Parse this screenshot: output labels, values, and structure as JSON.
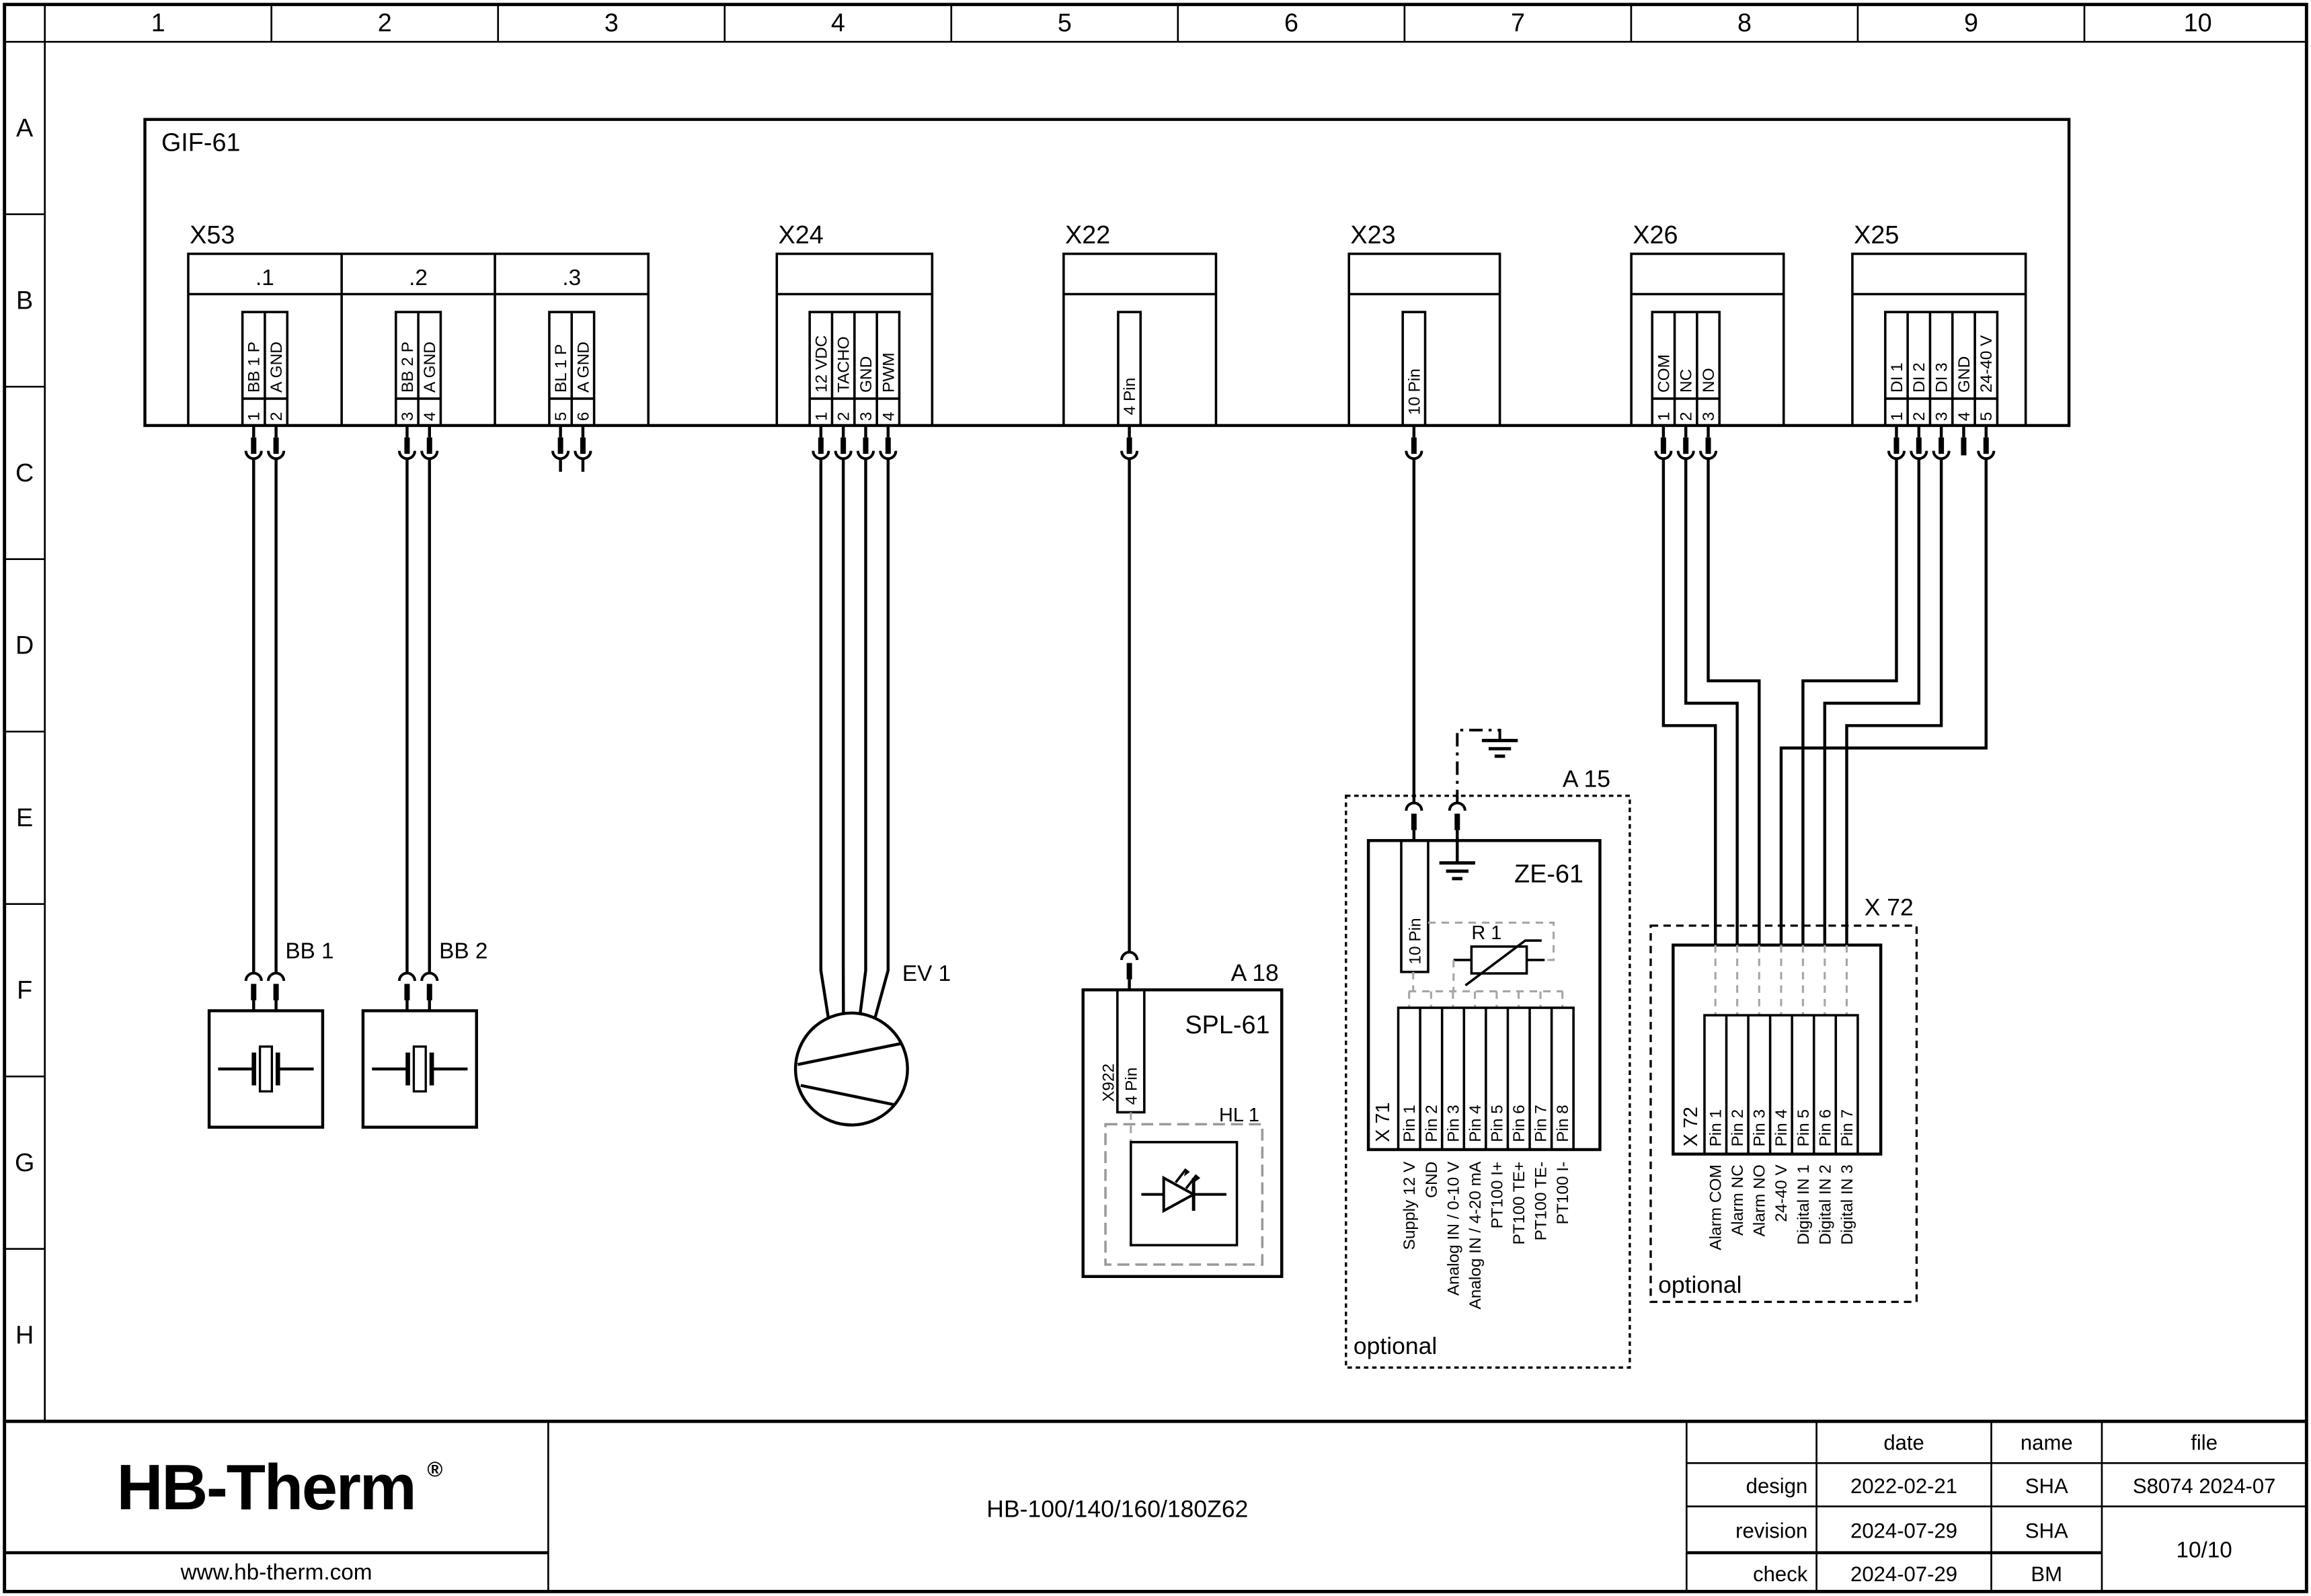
{
  "grid": {
    "cols": [
      "1",
      "2",
      "3",
      "4",
      "5",
      "6",
      "7",
      "8",
      "9",
      "10"
    ],
    "rows": [
      "A",
      "B",
      "C",
      "D",
      "E",
      "F",
      "G",
      "H"
    ]
  },
  "module": {
    "name": "GIF-61"
  },
  "x53": {
    "name": "X53",
    "sections": [
      {
        "id": ".1",
        "pins": [
          {
            "no": "1",
            "label": "BB 1 P"
          },
          {
            "no": "2",
            "label": "A GND"
          }
        ]
      },
      {
        "id": ".2",
        "pins": [
          {
            "no": "3",
            "label": "BB 2 P"
          },
          {
            "no": "4",
            "label": "A GND"
          }
        ]
      },
      {
        "id": ".3",
        "pins": [
          {
            "no": "5",
            "label": "BL 1 P"
          },
          {
            "no": "6",
            "label": "A GND"
          }
        ]
      }
    ]
  },
  "x24": {
    "name": "X24",
    "pins": [
      {
        "no": "1",
        "label": "12 VDC"
      },
      {
        "no": "2",
        "label": "TACHO"
      },
      {
        "no": "3",
        "label": "GND"
      },
      {
        "no": "4",
        "label": "PWM"
      }
    ]
  },
  "x22": {
    "name": "X22",
    "pin": "4 Pin"
  },
  "x23": {
    "name": "X23",
    "pin": "10 Pin"
  },
  "x26": {
    "name": "X26",
    "pins": [
      {
        "no": "1",
        "label": "COM"
      },
      {
        "no": "2",
        "label": "NC"
      },
      {
        "no": "3",
        "label": "NO"
      }
    ]
  },
  "x25": {
    "name": "X25",
    "pins": [
      {
        "no": "1",
        "label": "DI 1"
      },
      {
        "no": "2",
        "label": "DI 2"
      },
      {
        "no": "3",
        "label": "DI 3"
      },
      {
        "no": "4",
        "label": "GND"
      },
      {
        "no": "5",
        "label": "24-40 V"
      }
    ]
  },
  "bb1": {
    "name": "BB 1"
  },
  "bb2": {
    "name": "BB 2"
  },
  "ev1": {
    "name": "EV 1"
  },
  "a18": {
    "ref": "A 18",
    "name": "SPL-61",
    "connector": "X922",
    "pin": "4 Pin",
    "lamp": "HL 1"
  },
  "a15": {
    "ref": "A 15",
    "name": "ZE-61",
    "pin": "10 Pin",
    "resistor": "R 1",
    "terminal": "X 71",
    "pins": [
      "Pin 1",
      "Pin 2",
      "Pin 3",
      "Pin 4",
      "Pin 5",
      "Pin 6",
      "Pin 7",
      "Pin 8"
    ],
    "functions": [
      "Supply 12 V",
      "GND",
      "Analog IN / 0-10 V",
      "Analog IN / 4-20 mA",
      "PT100 I+",
      "PT100 TE+",
      "PT100 TE-",
      "PT100 I-"
    ],
    "note": "optional"
  },
  "x72": {
    "ref": "X 72",
    "terminal": "X 72",
    "pins": [
      "Pin 1",
      "Pin 2",
      "Pin 3",
      "Pin 4",
      "Pin 5",
      "Pin 6",
      "Pin 7"
    ],
    "functions": [
      "Alarm COM",
      "Alarm NC",
      "Alarm NO",
      "24-40 V",
      "Digital IN 1",
      "Digital IN 2",
      "Digital IN 3"
    ],
    "note": "optional"
  },
  "titleblock": {
    "logo": "HB-Therm",
    "registered": "®",
    "website": "www.hb-therm.com",
    "doc_title": "HB-100/140/160/180Z62",
    "headers": {
      "date": "date",
      "name": "name",
      "file": "file"
    },
    "entries": [
      {
        "label": "design",
        "date": "2022-02-21",
        "name": "SHA"
      },
      {
        "label": "revision",
        "date": "2024-07-29",
        "name": "SHA"
      },
      {
        "label": "check",
        "date": "2024-07-29",
        "name": "BM"
      }
    ],
    "file_no": "S8074 2024-07",
    "page": "10/10"
  },
  "colors": {
    "line": "#000000",
    "gray_wire": "#a6a6a6",
    "logo": "#1d2545"
  }
}
